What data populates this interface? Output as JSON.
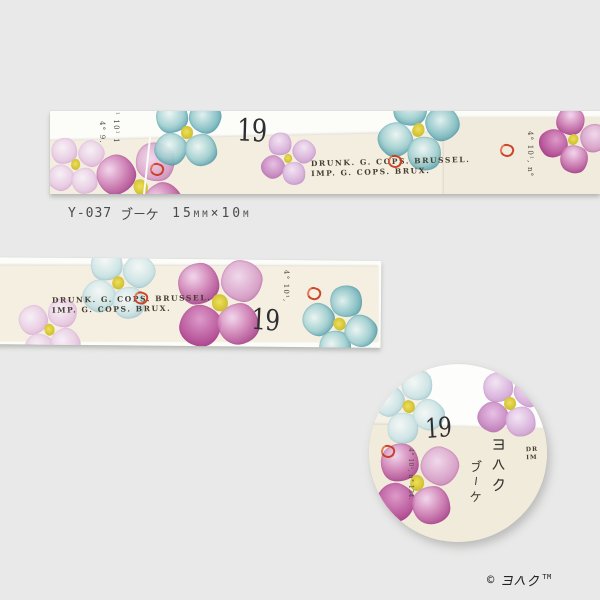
{
  "colors": {
    "background": "#e8e9e8",
    "backing_white": "#fcfcf9",
    "tape_cream": "#f3eee0",
    "flower_magenta": "#b4509c",
    "flower_teal": "#5fa5b2",
    "flower_lavender": "#c9a3d4",
    "flower_yellow": "#d8ca3a",
    "mark_red": "#c8381b",
    "ink": "#3e3a31"
  },
  "label": {
    "code": "Y-037",
    "name": "ブーケ",
    "size": "15mm×10m"
  },
  "print": {
    "number": "19",
    "stamp_line1": "DRUNK. G. COPS. BRUSSEL.",
    "stamp_line2": "IMP. G. COPS. BRUX.",
    "stamp_partial_line1": "DR",
    "stamp_partial_line2": "IM",
    "note_a": "¹ 10¹ 1",
    "note_b": "4° 9.",
    "note_c": "4° 10¹, n°",
    "note_d": "4° 10¹,",
    "note_detail": "4° 10¹, n° 134."
  },
  "detail_circle": {
    "brand": "ヨハク",
    "name": "ブーケ"
  },
  "footer": {
    "copyright": "©",
    "brand": "ヨハク",
    "trademark": "TM"
  }
}
